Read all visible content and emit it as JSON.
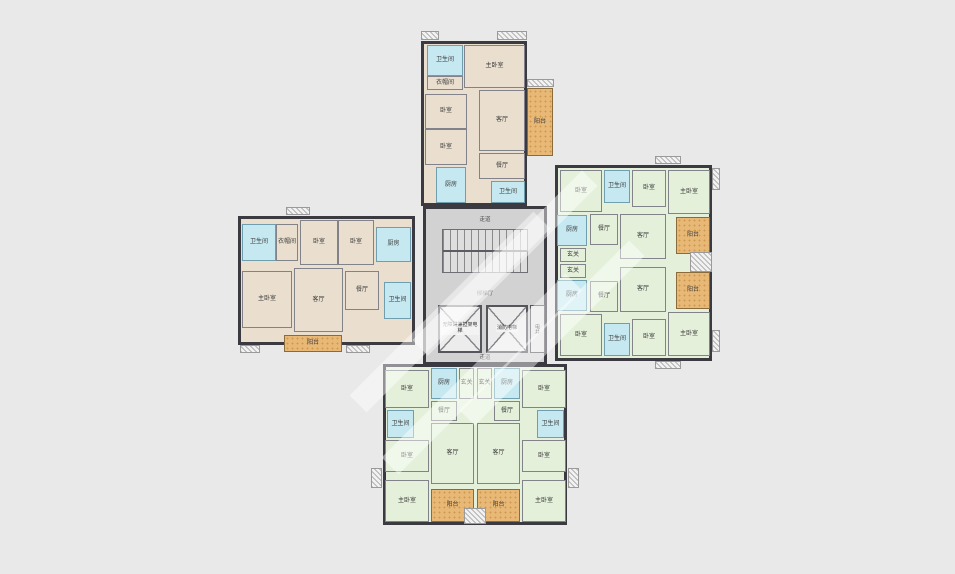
{
  "palette": {
    "background": "#e9e9e9",
    "unit_tan": "#eadfce",
    "unit_green": "#e4f0da",
    "wet_room_blue": "#c6e9f1",
    "balcony_orange": "#e8b877",
    "core_gray": "#d2d2d2",
    "wall": "#3a3a40"
  },
  "core": {
    "corridor_top": "走道",
    "hall": "候梯厅",
    "corridor_bottom": "走道",
    "elevator_left": "无障碍兼担架电梯",
    "elevator_right": "消防电梯",
    "shaft": "电井"
  },
  "wings": [
    {
      "id": "top-wing",
      "x": 421,
      "y": 41,
      "w": 106,
      "h": 165,
      "fill": "tan"
    },
    {
      "id": "left-wing",
      "x": 238,
      "y": 216,
      "w": 177,
      "h": 129,
      "fill": "tan"
    },
    {
      "id": "right-wing",
      "x": 555,
      "y": 165,
      "w": 157,
      "h": 196,
      "fill": "green"
    },
    {
      "id": "bottom-wing",
      "x": 383,
      "y": 364,
      "w": 184,
      "h": 161,
      "fill": "green"
    }
  ],
  "rooms": [
    {
      "id": "top-bath",
      "label": "卫生间",
      "x": 427,
      "y": 45,
      "w": 36,
      "h": 31,
      "fill": "blue"
    },
    {
      "id": "top-closet",
      "label": "衣帽间",
      "x": 427,
      "y": 76,
      "w": 36,
      "h": 14,
      "fill": "tan"
    },
    {
      "id": "top-master-bedroom",
      "label": "主卧室",
      "x": 464,
      "y": 45,
      "w": 61,
      "h": 43,
      "fill": "tan"
    },
    {
      "id": "top-bedroom-1",
      "label": "卧室",
      "x": 425,
      "y": 94,
      "w": 42,
      "h": 35,
      "fill": "tan"
    },
    {
      "id": "top-bedroom-2",
      "label": "卧室",
      "x": 425,
      "y": 129,
      "w": 42,
      "h": 36,
      "fill": "tan"
    },
    {
      "id": "top-living",
      "label": "客厅",
      "x": 479,
      "y": 90,
      "w": 46,
      "h": 61,
      "fill": "tan"
    },
    {
      "id": "top-dining",
      "label": "餐厅",
      "x": 479,
      "y": 153,
      "w": 46,
      "h": 26,
      "fill": "tan"
    },
    {
      "id": "top-kitchen",
      "label": "厨房",
      "x": 436,
      "y": 167,
      "w": 30,
      "h": 36,
      "fill": "blue"
    },
    {
      "id": "top-bath-2",
      "label": "卫生间",
      "x": 491,
      "y": 181,
      "w": 34,
      "h": 22,
      "fill": "blue"
    },
    {
      "id": "top-balcony",
      "label": "阳台",
      "x": 527,
      "y": 88,
      "w": 26,
      "h": 68,
      "fill": "orange"
    },
    {
      "id": "left-bath",
      "label": "卫生间",
      "x": 242,
      "y": 224,
      "w": 34,
      "h": 37,
      "fill": "blue"
    },
    {
      "id": "left-closet",
      "label": "衣帽间",
      "x": 276,
      "y": 224,
      "w": 22,
      "h": 37,
      "fill": "tan"
    },
    {
      "id": "left-bedroom-1",
      "label": "卧室",
      "x": 300,
      "y": 220,
      "w": 38,
      "h": 45,
      "fill": "tan"
    },
    {
      "id": "left-bedroom-2",
      "label": "卧室",
      "x": 338,
      "y": 220,
      "w": 36,
      "h": 45,
      "fill": "tan"
    },
    {
      "id": "left-kitchen",
      "label": "厨房",
      "x": 376,
      "y": 227,
      "w": 35,
      "h": 35,
      "fill": "blue"
    },
    {
      "id": "left-master-bedroom",
      "label": "主卧室",
      "x": 242,
      "y": 271,
      "w": 50,
      "h": 57,
      "fill": "tan"
    },
    {
      "id": "left-living",
      "label": "客厅",
      "x": 294,
      "y": 268,
      "w": 49,
      "h": 64,
      "fill": "tan"
    },
    {
      "id": "left-dining",
      "label": "餐厅",
      "x": 345,
      "y": 271,
      "w": 34,
      "h": 39,
      "fill": "tan"
    },
    {
      "id": "left-bath-2",
      "label": "卫生间",
      "x": 384,
      "y": 282,
      "w": 27,
      "h": 37,
      "fill": "blue"
    },
    {
      "id": "left-balcony",
      "label": "阳台",
      "x": 284,
      "y": 335,
      "w": 58,
      "h": 17,
      "fill": "orange"
    },
    {
      "id": "right-up-bedroom-1",
      "label": "卧室",
      "x": 560,
      "y": 170,
      "w": 42,
      "h": 42,
      "fill": "green"
    },
    {
      "id": "right-up-bath",
      "label": "卫生间",
      "x": 604,
      "y": 170,
      "w": 26,
      "h": 33,
      "fill": "blue"
    },
    {
      "id": "right-up-bedroom-2",
      "label": "卧室",
      "x": 632,
      "y": 170,
      "w": 34,
      "h": 37,
      "fill": "green"
    },
    {
      "id": "right-up-master-bedroom",
      "label": "主卧室",
      "x": 668,
      "y": 170,
      "w": 42,
      "h": 44,
      "fill": "green"
    },
    {
      "id": "right-up-kitchen",
      "label": "厨房",
      "x": 557,
      "y": 215,
      "w": 30,
      "h": 31,
      "fill": "blue"
    },
    {
      "id": "right-up-dining",
      "label": "餐厅",
      "x": 590,
      "y": 214,
      "w": 28,
      "h": 31,
      "fill": "green"
    },
    {
      "id": "right-up-living",
      "label": "客厅",
      "x": 620,
      "y": 214,
      "w": 46,
      "h": 45,
      "fill": "green"
    },
    {
      "id": "right-up-foyer",
      "label": "玄关",
      "x": 560,
      "y": 248,
      "w": 26,
      "h": 14,
      "fill": "green"
    },
    {
      "id": "right-up-balcony",
      "label": "阳台",
      "x": 676,
      "y": 217,
      "w": 34,
      "h": 37,
      "fill": "orange"
    },
    {
      "id": "right-low-foyer",
      "label": "玄关",
      "x": 560,
      "y": 264,
      "w": 26,
      "h": 14,
      "fill": "green"
    },
    {
      "id": "right-low-kitchen",
      "label": "厨房",
      "x": 557,
      "y": 280,
      "w": 30,
      "h": 31,
      "fill": "blue"
    },
    {
      "id": "right-low-dining",
      "label": "餐厅",
      "x": 590,
      "y": 281,
      "w": 28,
      "h": 31,
      "fill": "green"
    },
    {
      "id": "right-low-living",
      "label": "客厅",
      "x": 620,
      "y": 267,
      "w": 46,
      "h": 45,
      "fill": "green"
    },
    {
      "id": "right-low-balcony",
      "label": "阳台",
      "x": 676,
      "y": 272,
      "w": 34,
      "h": 37,
      "fill": "orange"
    },
    {
      "id": "right-low-bedroom-1",
      "label": "卧室",
      "x": 560,
      "y": 314,
      "w": 42,
      "h": 42,
      "fill": "green"
    },
    {
      "id": "right-low-bath",
      "label": "卫生间",
      "x": 604,
      "y": 323,
      "w": 26,
      "h": 33,
      "fill": "blue"
    },
    {
      "id": "right-low-bedroom-2",
      "label": "卧室",
      "x": 632,
      "y": 319,
      "w": 34,
      "h": 37,
      "fill": "green"
    },
    {
      "id": "right-low-master-bedroom",
      "label": "主卧室",
      "x": 668,
      "y": 312,
      "w": 42,
      "h": 44,
      "fill": "green"
    },
    {
      "id": "bottom-left-bedroom-1",
      "label": "卧室",
      "x": 385,
      "y": 370,
      "w": 44,
      "h": 38,
      "fill": "green"
    },
    {
      "id": "bottom-left-kitchen",
      "label": "厨房",
      "x": 431,
      "y": 368,
      "w": 26,
      "h": 31,
      "fill": "blue"
    },
    {
      "id": "bottom-left-foyer",
      "label": "玄关",
      "x": 459,
      "y": 368,
      "w": 15,
      "h": 31,
      "fill": "green"
    },
    {
      "id": "bottom-left-dining",
      "label": "餐厅",
      "x": 431,
      "y": 401,
      "w": 26,
      "h": 20,
      "fill": "green"
    },
    {
      "id": "bottom-left-bath",
      "label": "卫生间",
      "x": 387,
      "y": 410,
      "w": 27,
      "h": 28,
      "fill": "blue"
    },
    {
      "id": "bottom-left-bedroom-2",
      "label": "卧室",
      "x": 385,
      "y": 440,
      "w": 44,
      "h": 32,
      "fill": "green"
    },
    {
      "id": "bottom-left-living",
      "label": "客厅",
      "x": 431,
      "y": 423,
      "w": 43,
      "h": 61,
      "fill": "green"
    },
    {
      "id": "bottom-left-master-bedroom",
      "label": "主卧室",
      "x": 385,
      "y": 480,
      "w": 44,
      "h": 42,
      "fill": "green"
    },
    {
      "id": "bottom-left-balcony",
      "label": "阳台",
      "x": 431,
      "y": 489,
      "w": 43,
      "h": 33,
      "fill": "orange"
    },
    {
      "id": "bottom-right-bedroom-1",
      "label": "卧室",
      "x": 522,
      "y": 370,
      "w": 44,
      "h": 38,
      "fill": "green"
    },
    {
      "id": "bottom-right-kitchen",
      "label": "厨房",
      "x": 494,
      "y": 368,
      "w": 26,
      "h": 31,
      "fill": "blue"
    },
    {
      "id": "bottom-right-foyer",
      "label": "玄关",
      "x": 477,
      "y": 368,
      "w": 15,
      "h": 31,
      "fill": "green"
    },
    {
      "id": "bottom-right-dining",
      "label": "餐厅",
      "x": 494,
      "y": 401,
      "w": 26,
      "h": 20,
      "fill": "green"
    },
    {
      "id": "bottom-right-bath",
      "label": "卫生间",
      "x": 537,
      "y": 410,
      "w": 27,
      "h": 28,
      "fill": "blue"
    },
    {
      "id": "bottom-right-bedroom-2",
      "label": "卧室",
      "x": 522,
      "y": 440,
      "w": 44,
      "h": 32,
      "fill": "green"
    },
    {
      "id": "bottom-right-living",
      "label": "客厅",
      "x": 477,
      "y": 423,
      "w": 43,
      "h": 61,
      "fill": "green"
    },
    {
      "id": "bottom-right-master-bedroom",
      "label": "主卧室",
      "x": 522,
      "y": 480,
      "w": 44,
      "h": 42,
      "fill": "green"
    },
    {
      "id": "bottom-right-balcony",
      "label": "阳台",
      "x": 477,
      "y": 489,
      "w": 43,
      "h": 33,
      "fill": "orange"
    }
  ],
  "ac_platforms": [
    {
      "x": 421,
      "y": 31,
      "w": 18,
      "h": 9
    },
    {
      "x": 497,
      "y": 31,
      "w": 30,
      "h": 9
    },
    {
      "x": 527,
      "y": 79,
      "w": 27,
      "h": 8
    },
    {
      "x": 286,
      "y": 207,
      "w": 24,
      "h": 8
    },
    {
      "x": 240,
      "y": 345,
      "w": 20,
      "h": 8
    },
    {
      "x": 346,
      "y": 345,
      "w": 24,
      "h": 8
    },
    {
      "x": 655,
      "y": 156,
      "w": 26,
      "h": 8
    },
    {
      "x": 712,
      "y": 168,
      "w": 8,
      "h": 22
    },
    {
      "x": 655,
      "y": 361,
      "w": 26,
      "h": 8
    },
    {
      "x": 712,
      "y": 330,
      "w": 8,
      "h": 22
    },
    {
      "x": 690,
      "y": 252,
      "w": 22,
      "h": 20
    },
    {
      "x": 371,
      "y": 468,
      "w": 11,
      "h": 20
    },
    {
      "x": 568,
      "y": 468,
      "w": 11,
      "h": 20
    },
    {
      "x": 464,
      "y": 508,
      "w": 22,
      "h": 16
    },
    {
      "x": 438,
      "y": 355,
      "w": 22,
      "h": 8
    },
    {
      "x": 492,
      "y": 355,
      "w": 22,
      "h": 8
    }
  ]
}
